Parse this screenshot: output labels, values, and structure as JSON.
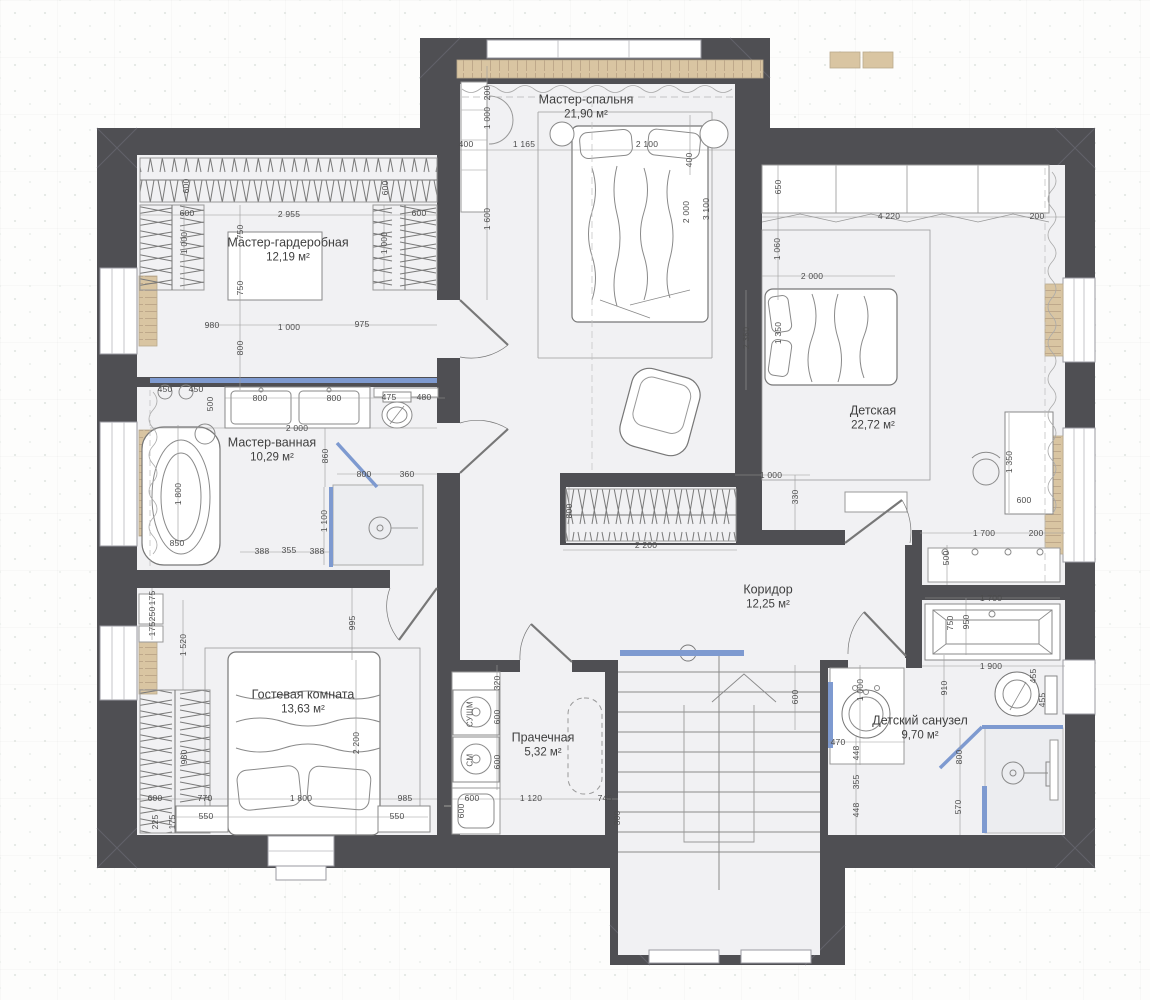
{
  "plan_title": "План этажа",
  "colors": {
    "wall": "#4f4f53",
    "floor": "#f1f1f3",
    "glass_blue": "#7e9ad0",
    "wood_tan": "#d9c5a2",
    "furniture_line": "#8a8a8a",
    "dim_text": "#4c4c4c"
  },
  "rooms": [
    {
      "id": "master-bedroom",
      "name": "Мастер-спальня",
      "area": "21,90 м²",
      "x": 586,
      "y": 107
    },
    {
      "id": "master-closet",
      "name": "Мастер-гардеробная",
      "area": "12,19 м²",
      "x": 288,
      "y": 250
    },
    {
      "id": "master-bath",
      "name": "Мастер-ванная",
      "area": "10,29 м²",
      "x": 272,
      "y": 450
    },
    {
      "id": "nursery",
      "name": "Детская",
      "area": "22,72 м²",
      "x": 873,
      "y": 418
    },
    {
      "id": "corridor",
      "name": "Коридор",
      "area": "12,25 м²",
      "x": 768,
      "y": 597
    },
    {
      "id": "guest-room",
      "name": "Гостевая комната",
      "area": "13,63 м²",
      "x": 303,
      "y": 702
    },
    {
      "id": "laundry",
      "name": "Прачечная",
      "area": "5,32 м²",
      "x": 543,
      "y": 745
    },
    {
      "id": "kids-bath",
      "name": "Детский санузел",
      "area": "9,70 м²",
      "x": 920,
      "y": 728
    }
  ],
  "appliances": [
    {
      "t": "СУШМ",
      "x": 470,
      "y": 714
    },
    {
      "t": "СМ",
      "x": 470,
      "y": 760
    }
  ],
  "dimensions": [
    {
      "t": "400",
      "x": 466,
      "y": 144,
      "r": 0
    },
    {
      "t": "1 165",
      "x": 524,
      "y": 144,
      "r": 0
    },
    {
      "t": "2 100",
      "x": 647,
      "y": 144,
      "r": 0
    },
    {
      "t": "200",
      "x": 487,
      "y": 93,
      "r": 1
    },
    {
      "t": "1 000",
      "x": 487,
      "y": 118,
      "r": 1
    },
    {
      "t": "1 600",
      "x": 487,
      "y": 219,
      "r": 1
    },
    {
      "t": "400",
      "x": 689,
      "y": 160,
      "r": 1
    },
    {
      "t": "2 000",
      "x": 686,
      "y": 212,
      "r": 1
    },
    {
      "t": "3 100",
      "x": 706,
      "y": 209,
      "r": 1
    },
    {
      "t": "600",
      "x": 187,
      "y": 213,
      "r": 0
    },
    {
      "t": "2 955",
      "x": 289,
      "y": 214,
      "r": 0
    },
    {
      "t": "600",
      "x": 419,
      "y": 213,
      "r": 0
    },
    {
      "t": "600",
      "x": 186,
      "y": 186,
      "r": 1
    },
    {
      "t": "600",
      "x": 385,
      "y": 188,
      "r": 1
    },
    {
      "t": "1 000",
      "x": 184,
      "y": 243,
      "r": 1
    },
    {
      "t": "1 000",
      "x": 384,
      "y": 243,
      "r": 1
    },
    {
      "t": "750",
      "x": 240,
      "y": 232,
      "r": 1
    },
    {
      "t": "750",
      "x": 240,
      "y": 288,
      "r": 1
    },
    {
      "t": "800",
      "x": 240,
      "y": 348,
      "r": 1
    },
    {
      "t": "980",
      "x": 212,
      "y": 325,
      "r": 0
    },
    {
      "t": "1 000",
      "x": 289,
      "y": 327,
      "r": 0
    },
    {
      "t": "975",
      "x": 362,
      "y": 324,
      "r": 0
    },
    {
      "t": "450",
      "x": 165,
      "y": 389,
      "r": 0
    },
    {
      "t": "450",
      "x": 196,
      "y": 389,
      "r": 0
    },
    {
      "t": "500",
      "x": 210,
      "y": 404,
      "r": 1
    },
    {
      "t": "800",
      "x": 260,
      "y": 398,
      "r": 0
    },
    {
      "t": "800",
      "x": 334,
      "y": 398,
      "r": 0
    },
    {
      "t": "475",
      "x": 389,
      "y": 397,
      "r": 0
    },
    {
      "t": "480",
      "x": 424,
      "y": 397,
      "r": 0
    },
    {
      "t": "2 000",
      "x": 297,
      "y": 428,
      "r": 0
    },
    {
      "t": "860",
      "x": 325,
      "y": 456,
      "r": 1
    },
    {
      "t": "800",
      "x": 364,
      "y": 474,
      "r": 0
    },
    {
      "t": "360",
      "x": 407,
      "y": 474,
      "r": 0
    },
    {
      "t": "1 100",
      "x": 324,
      "y": 521,
      "r": 1
    },
    {
      "t": "1 800",
      "x": 178,
      "y": 494,
      "r": 1
    },
    {
      "t": "850",
      "x": 177,
      "y": 543,
      "r": 0
    },
    {
      "t": "388",
      "x": 262,
      "y": 551,
      "r": 0
    },
    {
      "t": "355",
      "x": 289,
      "y": 550,
      "r": 0
    },
    {
      "t": "388",
      "x": 317,
      "y": 551,
      "r": 0
    },
    {
      "t": "650",
      "x": 778,
      "y": 187,
      "r": 1
    },
    {
      "t": "4 220",
      "x": 889,
      "y": 216,
      "r": 0
    },
    {
      "t": "200",
      "x": 1037,
      "y": 216,
      "r": 0
    },
    {
      "t": "1 060",
      "x": 777,
      "y": 249,
      "r": 1
    },
    {
      "t": "2 000",
      "x": 812,
      "y": 276,
      "r": 0
    },
    {
      "t": "2 350",
      "x": 746,
      "y": 338,
      "r": 1
    },
    {
      "t": "1 350",
      "x": 778,
      "y": 333,
      "r": 1
    },
    {
      "t": "330",
      "x": 795,
      "y": 497,
      "r": 1
    },
    {
      "t": "1 350",
      "x": 1009,
      "y": 462,
      "r": 1
    },
    {
      "t": "600",
      "x": 1024,
      "y": 500,
      "r": 0
    },
    {
      "t": "1 700",
      "x": 984,
      "y": 533,
      "r": 0
    },
    {
      "t": "200",
      "x": 1036,
      "y": 533,
      "r": 0
    },
    {
      "t": "500",
      "x": 946,
      "y": 558,
      "r": 1
    },
    {
      "t": "800",
      "x": 569,
      "y": 511,
      "r": 1
    },
    {
      "t": "2 200",
      "x": 646,
      "y": 545,
      "r": 0
    },
    {
      "t": "1 000",
      "x": 771,
      "y": 475,
      "r": 0
    },
    {
      "t": "175",
      "x": 152,
      "y": 598,
      "r": 1
    },
    {
      "t": "250",
      "x": 152,
      "y": 614,
      "r": 1
    },
    {
      "t": "175",
      "x": 152,
      "y": 629,
      "r": 1
    },
    {
      "t": "1 520",
      "x": 183,
      "y": 645,
      "r": 1
    },
    {
      "t": "995",
      "x": 352,
      "y": 623,
      "r": 1
    },
    {
      "t": "2 200",
      "x": 356,
      "y": 743,
      "r": 1
    },
    {
      "t": "980",
      "x": 184,
      "y": 757,
      "r": 1
    },
    {
      "t": "600",
      "x": 155,
      "y": 798,
      "r": 0
    },
    {
      "t": "770",
      "x": 205,
      "y": 798,
      "r": 0
    },
    {
      "t": "1 800",
      "x": 301,
      "y": 798,
      "r": 0
    },
    {
      "t": "985",
      "x": 405,
      "y": 798,
      "r": 0
    },
    {
      "t": "550",
      "x": 206,
      "y": 816,
      "r": 0
    },
    {
      "t": "550",
      "x": 397,
      "y": 816,
      "r": 0
    },
    {
      "t": "225",
      "x": 155,
      "y": 822,
      "r": 1
    },
    {
      "t": "175",
      "x": 172,
      "y": 822,
      "r": 1
    },
    {
      "t": "320",
      "x": 497,
      "y": 683,
      "r": 1
    },
    {
      "t": "600",
      "x": 497,
      "y": 717,
      "r": 1
    },
    {
      "t": "600",
      "x": 497,
      "y": 762,
      "r": 1
    },
    {
      "t": "600",
      "x": 472,
      "y": 798,
      "r": 0
    },
    {
      "t": "1 120",
      "x": 531,
      "y": 798,
      "r": 0
    },
    {
      "t": "745",
      "x": 605,
      "y": 798,
      "r": 0
    },
    {
      "t": "300",
      "x": 617,
      "y": 818,
      "r": 1
    },
    {
      "t": "600",
      "x": 461,
      "y": 811,
      "r": 1
    },
    {
      "t": "600",
      "x": 795,
      "y": 697,
      "r": 1
    },
    {
      "t": "1 700",
      "x": 991,
      "y": 598,
      "r": 0
    },
    {
      "t": "750",
      "x": 950,
      "y": 623,
      "r": 1
    },
    {
      "t": "950",
      "x": 966,
      "y": 622,
      "r": 1
    },
    {
      "t": "1 900",
      "x": 991,
      "y": 666,
      "r": 0
    },
    {
      "t": "1 000",
      "x": 860,
      "y": 690,
      "r": 1
    },
    {
      "t": "470",
      "x": 838,
      "y": 742,
      "r": 0
    },
    {
      "t": "910",
      "x": 944,
      "y": 688,
      "r": 1
    },
    {
      "t": "455",
      "x": 1033,
      "y": 676,
      "r": 1
    },
    {
      "t": "455",
      "x": 1042,
      "y": 700,
      "r": 1
    },
    {
      "t": "448",
      "x": 856,
      "y": 753,
      "r": 1
    },
    {
      "t": "355",
      "x": 856,
      "y": 782,
      "r": 1
    },
    {
      "t": "448",
      "x": 856,
      "y": 810,
      "r": 1
    },
    {
      "t": "800",
      "x": 959,
      "y": 757,
      "r": 1
    },
    {
      "t": "570",
      "x": 958,
      "y": 807,
      "r": 1
    }
  ]
}
